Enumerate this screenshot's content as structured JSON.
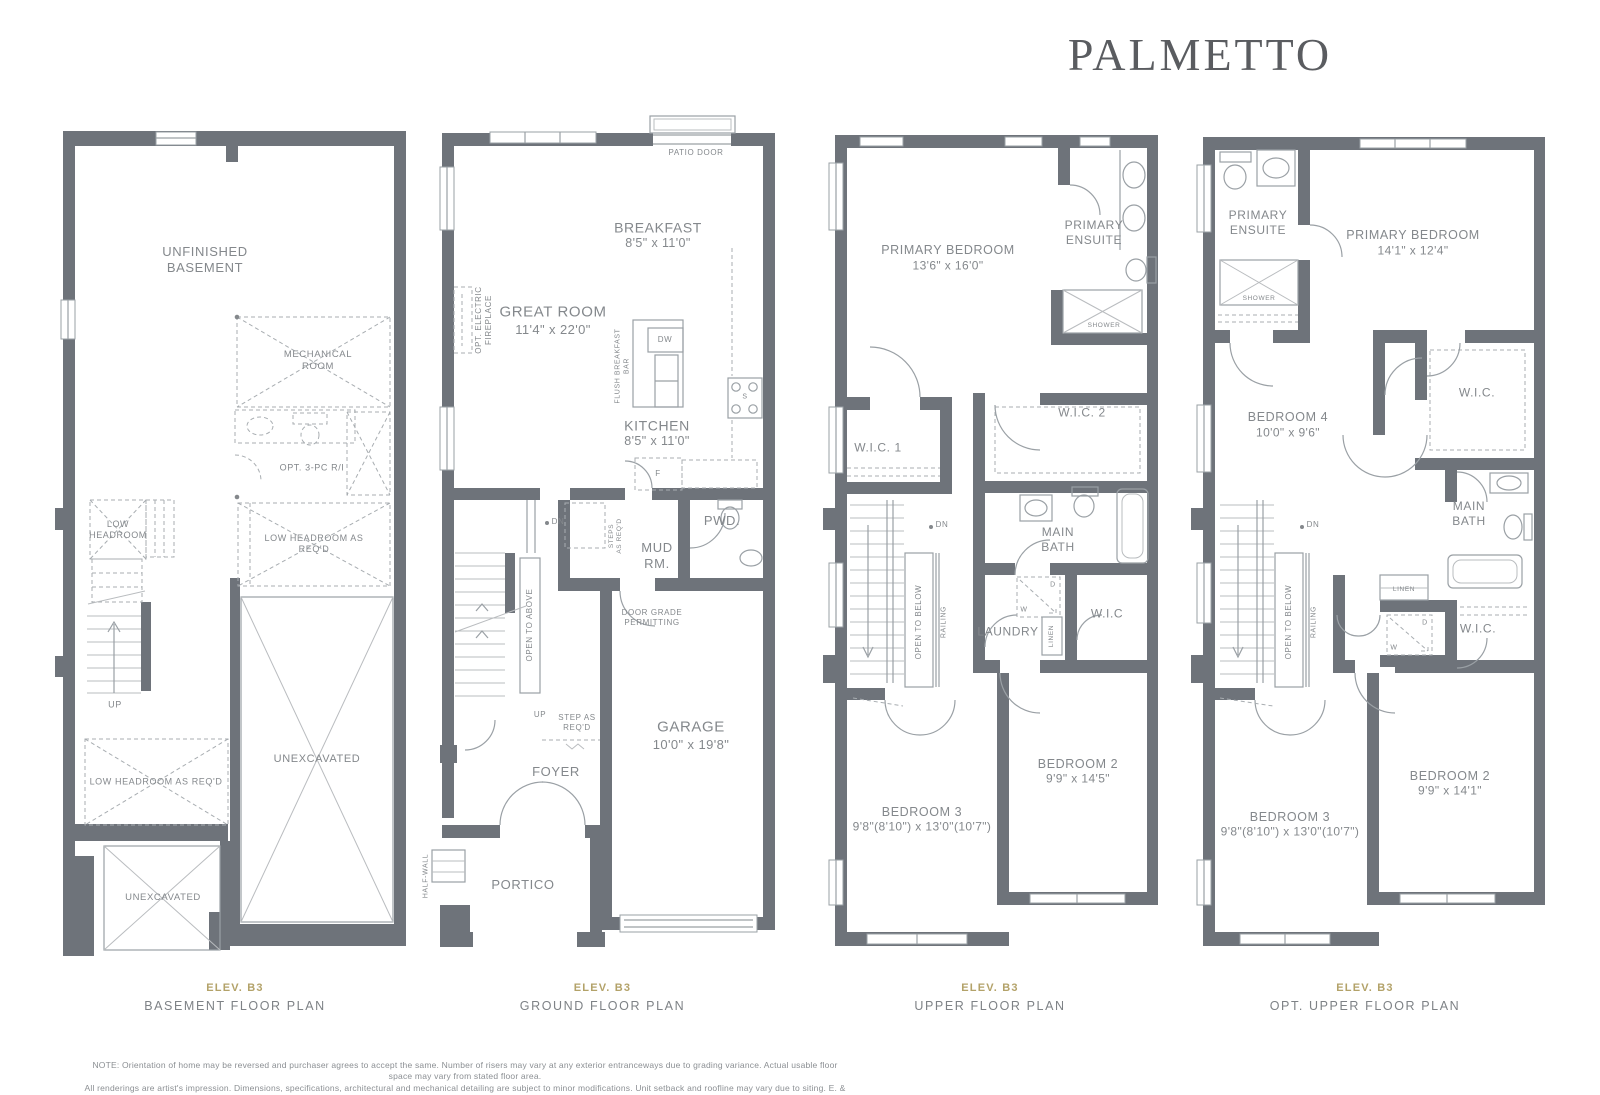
{
  "title": "PALMETTO",
  "colors": {
    "accent_gold": "#b3a269",
    "wall_gray": "#6e737a",
    "label_gray": "#84888c"
  },
  "plans": [
    {
      "caption": {
        "elev": "ELEV. B3",
        "name": "BASEMENT FLOOR PLAN"
      },
      "labels": {
        "unfinished_basement": "UNFINISHED\nBASEMENT",
        "mechanical_room": "MECHANICAL ROOM",
        "opt_3pc": "OPT. 3-PC R/I",
        "low_headroom": "LOW\nHEADROOM",
        "low_headroom_req_right": "LOW HEADROOM AS REQ'D",
        "up": "UP",
        "low_headroom_req_left": "LOW HEADROOM AS REQ'D",
        "unexcavated_main": "UNEXCAVATED",
        "unexcavated_front": "UNEXCAVATED"
      }
    },
    {
      "caption": {
        "elev": "ELEV. B3",
        "name": "GROUND FLOOR PLAN"
      },
      "labels": {
        "patio_door": "PATIO DOOR",
        "breakfast": "BREAKFAST",
        "breakfast_dims": "8'5\" x 11'0\"",
        "great_room": "GREAT ROOM",
        "great_room_dims": "11'4\" x 22'0\"",
        "opt_fireplace": "OPT. ELECTRIC\nFIREPLACE",
        "flush_bar": "FLUSH BREAKFAST\nBAR",
        "dw": "DW",
        "stove": "S",
        "kitchen": "KITCHEN",
        "kitchen_dims": "8'5\" x 11'0\"",
        "fridge": "F",
        "pwd": "PWD.",
        "mud_rm": "MUD\nRM.",
        "steps_req": "STEPS\nAS REQ'D",
        "dn": "DN",
        "open_to_above": "OPEN TO ABOVE",
        "up": "UP",
        "step_req": "STEP AS\nREQ'D",
        "door_grade": "DOOR GRADE\nPERMITTING",
        "garage": "GARAGE",
        "garage_dims": "10'0\" x 19'8\"",
        "foyer": "FOYER",
        "portico": "PORTICO",
        "half_wall": "HALF-WALL"
      }
    },
    {
      "caption": {
        "elev": "ELEV. B3",
        "name": "UPPER FLOOR PLAN"
      },
      "labels": {
        "primary_bedroom": "PRIMARY BEDROOM",
        "primary_bedroom_dims": "13'6\" x 16'0\"",
        "primary_ensuite": "PRIMARY\nENSUITE",
        "shower": "SHOWER",
        "wic1": "W.I.C. 1",
        "wic2": "W.I.C. 2",
        "main_bath": "MAIN\nBATH",
        "dn": "DN",
        "open_to_below": "OPEN TO BELOW",
        "railing": "RAILING",
        "laundry": "LAUNDRY",
        "dryer": "D",
        "washer": "W",
        "linen": "LINEN",
        "wic": "W.I.C",
        "bedroom2": "BEDROOM 2",
        "bedroom2_dims": "9'9\" x 14'5\"",
        "bedroom3": "BEDROOM 3",
        "bedroom3_dims": "9'8\"(8'10\") x 13'0\"(10'7\")"
      }
    },
    {
      "caption": {
        "elev": "ELEV. B3",
        "name": "OPT. UPPER FLOOR PLAN"
      },
      "labels": {
        "primary_ensuite": "PRIMARY\nENSUITE",
        "shower": "SHOWER",
        "primary_bedroom": "PRIMARY BEDROOM",
        "primary_bedroom_dims": "14'1\" x 12'4\"",
        "bedroom4": "BEDROOM 4",
        "bedroom4_dims": "10'0\" x 9'6\"",
        "wic_top": "W.I.C.",
        "main_bath": "MAIN\nBATH",
        "linen": "LINEN",
        "dn": "DN",
        "open_to_below": "OPEN TO BELOW",
        "railing": "RAILING",
        "dryer": "D",
        "washer": "W",
        "wic_mid": "W.I.C.",
        "bedroom2": "BEDROOM 2",
        "bedroom2_dims": "9'9\" x 14'1\"",
        "bedroom3": "BEDROOM 3",
        "bedroom3_dims": "9'8\"(8'10\") x 13'0\"(10'7\")"
      }
    }
  ],
  "note": {
    "line1": "NOTE: Orientation of home may be reversed and purchaser agrees to accept the same. Number of risers may vary at any exterior entranceways due to grading variance. Actual usable floor space may vary from stated floor area.",
    "line2": "All renderings are artist's impression. Dimensions, specifications, architectural and mechanical detailing are subject to minor modifications. Unit setback and roofline may vary due to siting. E. & O. E."
  }
}
